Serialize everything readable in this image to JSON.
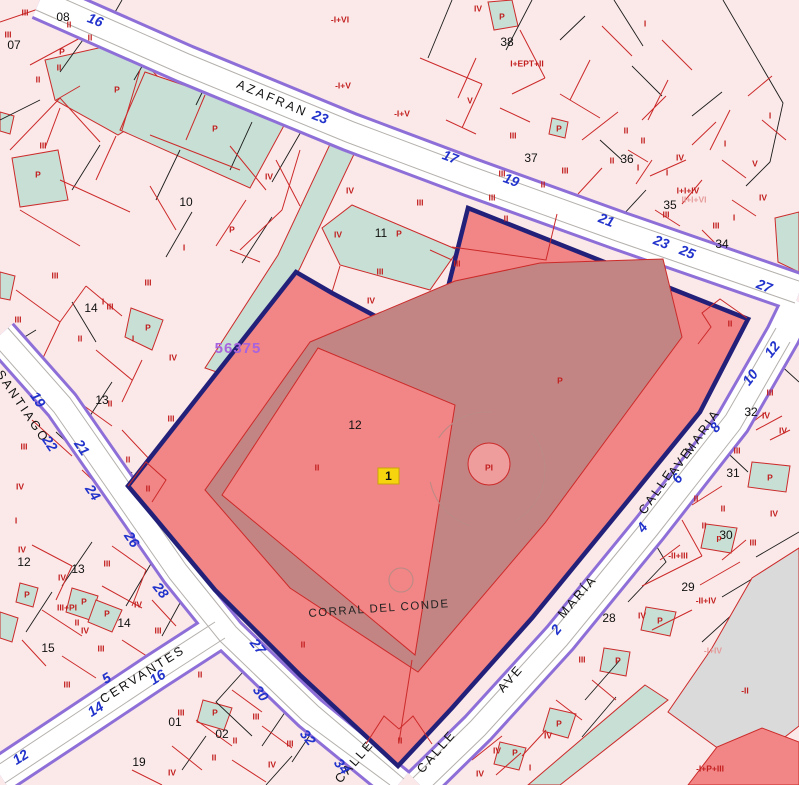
{
  "map": {
    "block_number": "56375",
    "selected_parcel": {
      "name": "CORRAL DEL CONDE",
      "number": "12",
      "marker_label": "1",
      "floors_label": "II",
      "patio_label": "P",
      "pool_label": "PI"
    },
    "streets": [
      "AZAFRAN",
      "SANTIAGO",
      "CERVANTES",
      "CALLE AVE MARÍA",
      "CALLE"
    ],
    "colors": {
      "parcel_highlight": "#F28585",
      "parcel_inner": "#C38583",
      "selection_border": "#23207A",
      "street_edge": "#8E6FD8",
      "parcel_line": "#CC2A2A",
      "green_area": "#C7DFD4",
      "block_fill": "#FBE9E9",
      "gray_area": "#DADADA",
      "street_number": "#2233CC",
      "floor_label": "#C21E1E",
      "block_number": "#A863DE",
      "marker_bg": "#F6D40E"
    },
    "labels": {
      "street_names": [
        {
          "t": "AZAFRAN",
          "x": 272,
          "y": 99,
          "r": 23
        },
        {
          "t": "SANTIAGO",
          "x": 22,
          "y": 407,
          "r": 56
        },
        {
          "t": "CERVANTES",
          "x": 143,
          "y": 675,
          "r": -32
        },
        {
          "t": "CALLE",
          "x": 657,
          "y": 492,
          "r": -55
        },
        {
          "t": "AVE",
          "x": 681,
          "y": 462,
          "r": -55
        },
        {
          "t": "MARIA",
          "x": 703,
          "y": 432,
          "r": -55
        },
        {
          "t": "CALLE",
          "x": 437,
          "y": 752,
          "r": -49
        },
        {
          "t": "AVE",
          "x": 511,
          "y": 679,
          "r": -49
        },
        {
          "t": "MARÍA",
          "x": 578,
          "y": 597,
          "r": -49
        },
        {
          "t": "CALLE",
          "x": 355,
          "y": 762,
          "r": -49
        }
      ],
      "street_numbers": [
        {
          "t": "16",
          "x": 95,
          "y": 21,
          "r": 21
        },
        {
          "t": "23",
          "x": 320,
          "y": 118,
          "r": 21
        },
        {
          "t": "17",
          "x": 450,
          "y": 158,
          "r": 21
        },
        {
          "t": "19",
          "x": 511,
          "y": 181,
          "r": 21
        },
        {
          "t": "21",
          "x": 606,
          "y": 221,
          "r": 21
        },
        {
          "t": "23",
          "x": 661,
          "y": 243,
          "r": 21
        },
        {
          "t": "25",
          "x": 687,
          "y": 253,
          "r": 21
        },
        {
          "t": "27",
          "x": 764,
          "y": 287,
          "r": 21
        },
        {
          "t": "19",
          "x": 37,
          "y": 400,
          "r": 56
        },
        {
          "t": "22",
          "x": 49,
          "y": 444,
          "r": 56
        },
        {
          "t": "21",
          "x": 81,
          "y": 448,
          "r": 56
        },
        {
          "t": "24",
          "x": 92,
          "y": 493,
          "r": 56
        },
        {
          "t": "26",
          "x": 131,
          "y": 540,
          "r": 56
        },
        {
          "t": "28",
          "x": 160,
          "y": 591,
          "r": 52
        },
        {
          "t": "27",
          "x": 257,
          "y": 647,
          "r": 52
        },
        {
          "t": "30",
          "x": 260,
          "y": 694,
          "r": 52
        },
        {
          "t": "32",
          "x": 307,
          "y": 738,
          "r": 52
        },
        {
          "t": "34",
          "x": 341,
          "y": 767,
          "r": 52
        },
        {
          "t": "5",
          "x": 107,
          "y": 679,
          "r": -32
        },
        {
          "t": "16",
          "x": 158,
          "y": 678,
          "r": -32
        },
        {
          "t": "14",
          "x": 96,
          "y": 710,
          "r": -32
        },
        {
          "t": "12",
          "x": 21,
          "y": 758,
          "r": -32
        },
        {
          "t": "2",
          "x": 557,
          "y": 630,
          "r": -52
        },
        {
          "t": "4",
          "x": 643,
          "y": 528,
          "r": -52
        },
        {
          "t": "6",
          "x": 678,
          "y": 479,
          "r": -52
        },
        {
          "t": "8",
          "x": 716,
          "y": 428,
          "r": -52
        },
        {
          "t": "10",
          "x": 751,
          "y": 378,
          "r": -52
        },
        {
          "t": "12",
          "x": 773,
          "y": 350,
          "r": -52
        }
      ],
      "parcel_numbers": [
        {
          "t": "07",
          "x": 14,
          "y": 46
        },
        {
          "t": "08",
          "x": 63,
          "y": 18
        },
        {
          "t": "10",
          "x": 186,
          "y": 203
        },
        {
          "t": "11",
          "x": 381,
          "y": 234
        },
        {
          "t": "38",
          "x": 507,
          "y": 43
        },
        {
          "t": "37",
          "x": 531,
          "y": 159
        },
        {
          "t": "36",
          "x": 627,
          "y": 160
        },
        {
          "t": "35",
          "x": 670,
          "y": 206
        },
        {
          "t": "34",
          "x": 722,
          "y": 245
        },
        {
          "t": "14",
          "x": 91,
          "y": 309
        },
        {
          "t": "13",
          "x": 102,
          "y": 401
        },
        {
          "t": "12",
          "x": 355,
          "y": 426
        },
        {
          "t": "12",
          "x": 24,
          "y": 563
        },
        {
          "t": "13",
          "x": 78,
          "y": 570
        },
        {
          "t": "14",
          "x": 124,
          "y": 624
        },
        {
          "t": "15",
          "x": 48,
          "y": 649
        },
        {
          "t": "01",
          "x": 175,
          "y": 723
        },
        {
          "t": "02",
          "x": 222,
          "y": 735
        },
        {
          "t": "19",
          "x": 139,
          "y": 763
        },
        {
          "t": "28",
          "x": 609,
          "y": 619
        },
        {
          "t": "29",
          "x": 688,
          "y": 588
        },
        {
          "t": "30",
          "x": 726,
          "y": 536
        },
        {
          "t": "31",
          "x": 733,
          "y": 474
        },
        {
          "t": "32",
          "x": 751,
          "y": 413
        }
      ],
      "floor_labels": [
        {
          "t": "III",
          "x": 25,
          "y": 13
        },
        {
          "t": "II",
          "x": 69,
          "y": 25
        },
        {
          "t": "II",
          "x": 90,
          "y": 38
        },
        {
          "t": "III",
          "x": 8,
          "y": 35
        },
        {
          "t": "P",
          "x": 62,
          "y": 52
        },
        {
          "t": "II",
          "x": 59,
          "y": 68
        },
        {
          "t": "II",
          "x": 38,
          "y": 80
        },
        {
          "t": "P",
          "x": 117,
          "y": 90
        },
        {
          "t": "III",
          "x": 43,
          "y": 146
        },
        {
          "t": "P",
          "x": 38,
          "y": 175
        },
        {
          "t": "P",
          "x": 215,
          "y": 129
        },
        {
          "t": "III",
          "x": 55,
          "y": 276
        },
        {
          "t": "IV",
          "x": 269,
          "y": 177
        },
        {
          "t": "P",
          "x": 232,
          "y": 230
        },
        {
          "t": "I",
          "x": 184,
          "y": 248
        },
        {
          "t": "III",
          "x": 148,
          "y": 283
        },
        {
          "t": "IV",
          "x": 350,
          "y": 191
        },
        {
          "t": "III",
          "x": 420,
          "y": 203
        },
        {
          "t": "P",
          "x": 399,
          "y": 234
        },
        {
          "t": "IV",
          "x": 338,
          "y": 235
        },
        {
          "t": "III",
          "x": 380,
          "y": 272
        },
        {
          "t": "IV",
          "x": 371,
          "y": 301
        },
        {
          "t": "III",
          "x": 457,
          "y": 264
        },
        {
          "t": "III",
          "x": 492,
          "y": 198
        },
        {
          "t": "-I+VI",
          "x": 340,
          "y": 20
        },
        {
          "t": "-I+V",
          "x": 343,
          "y": 86
        },
        {
          "t": "-I+V",
          "x": 402,
          "y": 114
        },
        {
          "t": "IV",
          "x": 478,
          "y": 9
        },
        {
          "t": "P",
          "x": 502,
          "y": 17
        },
        {
          "t": "I",
          "x": 645,
          "y": 24
        },
        {
          "t": "I+EPT+II",
          "x": 527,
          "y": 64
        },
        {
          "t": "V",
          "x": 470,
          "y": 101
        },
        {
          "t": "III",
          "x": 513,
          "y": 136
        },
        {
          "t": "II",
          "x": 626,
          "y": 131
        },
        {
          "t": "II",
          "x": 643,
          "y": 141
        },
        {
          "t": "P",
          "x": 559,
          "y": 129
        },
        {
          "t": "III",
          "x": 565,
          "y": 171
        },
        {
          "t": "III",
          "x": 502,
          "y": 174
        },
        {
          "t": "II",
          "x": 543,
          "y": 185
        },
        {
          "t": "II",
          "x": 612,
          "y": 161
        },
        {
          "t": "I",
          "x": 638,
          "y": 168
        },
        {
          "t": "IV",
          "x": 680,
          "y": 158
        },
        {
          "t": "I+I+IV",
          "x": 688,
          "y": 191
        },
        {
          "t": "III",
          "x": 666,
          "y": 215
        },
        {
          "t": "I",
          "x": 667,
          "y": 173
        },
        {
          "t": "V",
          "x": 755,
          "y": 164
        },
        {
          "t": "I",
          "x": 725,
          "y": 144
        },
        {
          "t": "IV",
          "x": 763,
          "y": 198
        },
        {
          "t": "I",
          "x": 734,
          "y": 218
        },
        {
          "t": "III",
          "x": 716,
          "y": 226
        },
        {
          "t": "I",
          "x": 770,
          "y": 116
        },
        {
          "t": "III",
          "x": 18,
          "y": 320
        },
        {
          "t": "II",
          "x": 80,
          "y": 339
        },
        {
          "t": "I",
          "x": 103,
          "y": 302
        },
        {
          "t": "IV",
          "x": 173,
          "y": 358
        },
        {
          "t": "P",
          "x": 148,
          "y": 328
        },
        {
          "t": "I",
          "x": 133,
          "y": 339
        },
        {
          "t": "III",
          "x": 171,
          "y": 419
        },
        {
          "t": "II",
          "x": 128,
          "y": 460
        },
        {
          "t": "III",
          "x": 24,
          "y": 447
        },
        {
          "t": "II",
          "x": 110,
          "y": 404
        },
        {
          "t": "III",
          "x": 110,
          "y": 307
        },
        {
          "t": "IV",
          "x": 20,
          "y": 487
        },
        {
          "t": "I",
          "x": 16,
          "y": 521
        },
        {
          "t": "IV",
          "x": 22,
          "y": 550
        },
        {
          "t": "III",
          "x": 107,
          "y": 564
        },
        {
          "t": "IV",
          "x": 62,
          "y": 578
        },
        {
          "t": "P",
          "x": 27,
          "y": 595
        },
        {
          "t": "III+PI",
          "x": 67,
          "y": 608
        },
        {
          "t": "P",
          "x": 84,
          "y": 602
        },
        {
          "t": "P",
          "x": 107,
          "y": 614
        },
        {
          "t": "IV",
          "x": 138,
          "y": 605
        },
        {
          "t": "II",
          "x": 77,
          "y": 623
        },
        {
          "t": "IV",
          "x": 85,
          "y": 631
        },
        {
          "t": "III",
          "x": 158,
          "y": 631
        },
        {
          "t": "III",
          "x": 101,
          "y": 649
        },
        {
          "t": "III",
          "x": 67,
          "y": 685
        },
        {
          "t": "II",
          "x": 200,
          "y": 675
        },
        {
          "t": "III",
          "x": 181,
          "y": 713
        },
        {
          "t": "II",
          "x": 235,
          "y": 741
        },
        {
          "t": "II",
          "x": 214,
          "y": 758
        },
        {
          "t": "III",
          "x": 256,
          "y": 717
        },
        {
          "t": "III",
          "x": 290,
          "y": 744
        },
        {
          "t": "IV",
          "x": 272,
          "y": 765
        },
        {
          "t": "IV",
          "x": 172,
          "y": 773
        },
        {
          "t": "P",
          "x": 215,
          "y": 713
        },
        {
          "t": "III",
          "x": 582,
          "y": 660
        },
        {
          "t": "IV",
          "x": 642,
          "y": 616
        },
        {
          "t": "P",
          "x": 660,
          "y": 621
        },
        {
          "t": "P",
          "x": 618,
          "y": 661
        },
        {
          "t": "IV",
          "x": 548,
          "y": 736
        },
        {
          "t": "IV",
          "x": 497,
          "y": 751
        },
        {
          "t": "P",
          "x": 515,
          "y": 753
        },
        {
          "t": "I",
          "x": 530,
          "y": 768
        },
        {
          "t": "IV",
          "x": 480,
          "y": 774
        },
        {
          "t": "P",
          "x": 559,
          "y": 724
        },
        {
          "t": "-II+III",
          "x": 678,
          "y": 556
        },
        {
          "t": "-II+IV",
          "x": 706,
          "y": 601
        },
        {
          "t": "-II",
          "x": 745,
          "y": 691
        },
        {
          "t": "-I+P+III",
          "x": 710,
          "y": 769
        },
        {
          "t": "III",
          "x": 753,
          "y": 543
        },
        {
          "t": "p",
          "x": 719,
          "y": 538
        },
        {
          "t": "III",
          "x": 770,
          "y": 393
        },
        {
          "t": "IV",
          "x": 766,
          "y": 416
        },
        {
          "t": "IV",
          "x": 783,
          "y": 431
        },
        {
          "t": "III",
          "x": 737,
          "y": 451
        },
        {
          "t": "II",
          "x": 696,
          "y": 499
        },
        {
          "t": "II",
          "x": 723,
          "y": 509
        },
        {
          "t": "II",
          "x": 704,
          "y": 526
        },
        {
          "t": "IV",
          "x": 774,
          "y": 514
        },
        {
          "t": "P",
          "x": 770,
          "y": 478
        },
        {
          "t": "P",
          "x": 560,
          "y": 381
        },
        {
          "t": "PI",
          "x": 489,
          "y": 468
        },
        {
          "t": "II",
          "x": 506,
          "y": 219
        },
        {
          "t": "II",
          "x": 730,
          "y": 324
        },
        {
          "t": "II",
          "x": 400,
          "y": 741
        },
        {
          "t": "II",
          "x": 148,
          "y": 489
        },
        {
          "t": "II",
          "x": 317,
          "y": 468
        },
        {
          "t": "II",
          "x": 303,
          "y": 645
        }
      ],
      "faded_labels": [
        {
          "t": "II+I+VI",
          "x": 694,
          "y": 200
        },
        {
          "t": "-I+IV",
          "x": 713,
          "y": 651
        }
      ],
      "block_number_label": {
        "t": "56375",
        "x": 238,
        "y": 349
      },
      "place_name": {
        "t": "CORRAL DEL CONDE",
        "x": 379,
        "y": 609,
        "r": -4
      }
    }
  }
}
